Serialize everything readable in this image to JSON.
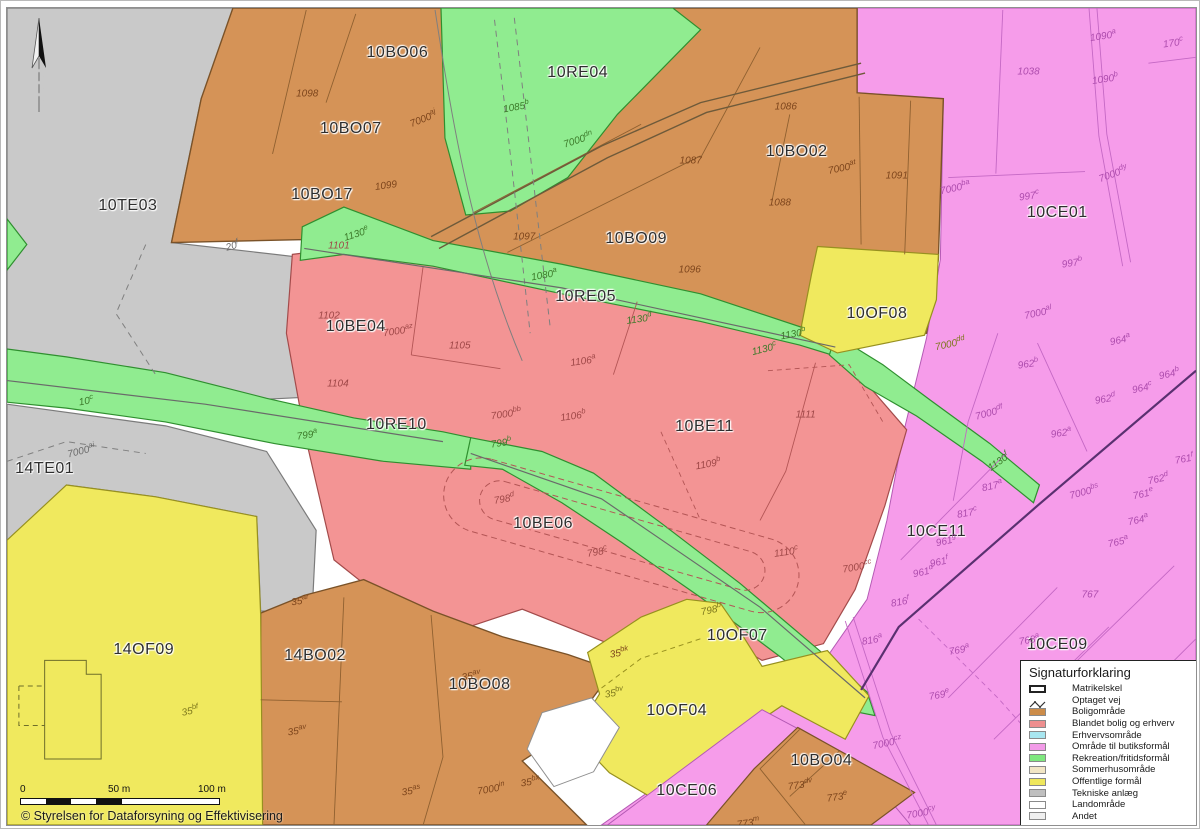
{
  "copyright": "© Styrelsen for Dataforsyning og Effektivisering",
  "scale_bar": {
    "labels": [
      "0",
      "50 m",
      "100 m"
    ]
  },
  "legend": {
    "title": "Signaturforklaring",
    "items": [
      {
        "label": "Matrikelskel",
        "symbol": "outline",
        "color": "#FFFFFF"
      },
      {
        "label": "Optaget vej",
        "symbol": "zigzag",
        "color": "#333333"
      },
      {
        "label": "Boligområde",
        "symbol": "fill",
        "color": "#CC8C49"
      },
      {
        "label": "Blandet bolig og erhverv",
        "symbol": "fill",
        "color": "#EE8F8F"
      },
      {
        "label": "Erhvervsområde",
        "symbol": "fill",
        "color": "#A8E6F0"
      },
      {
        "label": "Område til butiksformål",
        "symbol": "fill",
        "color": "#F29BE8"
      },
      {
        "label": "Rekreation/fritidsformål",
        "symbol": "fill",
        "color": "#7FE87F"
      },
      {
        "label": "Sommerhusområde",
        "symbol": "fill",
        "color": "#F2E6C5"
      },
      {
        "label": "Offentlige formål",
        "symbol": "fill",
        "color": "#EFE75C"
      },
      {
        "label": "Tekniske anlæg",
        "symbol": "fill",
        "color": "#BFBFBF"
      },
      {
        "label": "Landområde",
        "symbol": "fill",
        "color": "#FFFFFF"
      },
      {
        "label": "Andet",
        "symbol": "fill",
        "color": "#EFEFEF"
      }
    ]
  },
  "zone_colors": {
    "boligomraade": "#D59357",
    "blandet": "#F39494",
    "rekreation": "#90EC90",
    "butiksformaal": "#F69CEA",
    "offentlige": "#F0E95E",
    "tekniske": "#C9C9C9"
  },
  "zone_labels": [
    {
      "text": "10TE03",
      "x": 122,
      "y": 201
    },
    {
      "text": "10BO06",
      "x": 394,
      "y": 46
    },
    {
      "text": "10BO07",
      "x": 347,
      "y": 123
    },
    {
      "text": "10BO17",
      "x": 318,
      "y": 190
    },
    {
      "text": "10RE04",
      "x": 576,
      "y": 66
    },
    {
      "text": "10BO02",
      "x": 797,
      "y": 146
    },
    {
      "text": "10BO09",
      "x": 635,
      "y": 234
    },
    {
      "text": "10CE01",
      "x": 1060,
      "y": 208
    },
    {
      "text": "10RE05",
      "x": 584,
      "y": 293
    },
    {
      "text": "10BE04",
      "x": 352,
      "y": 324
    },
    {
      "text": "10OF08",
      "x": 878,
      "y": 310
    },
    {
      "text": "10RE10",
      "x": 393,
      "y": 423
    },
    {
      "text": "10BE11",
      "x": 704,
      "y": 425
    },
    {
      "text": "14TE01",
      "x": 38,
      "y": 468
    },
    {
      "text": "10BE06",
      "x": 541,
      "y": 524
    },
    {
      "text": "10CE11",
      "x": 938,
      "y": 532
    },
    {
      "text": "14OF09",
      "x": 138,
      "y": 651
    },
    {
      "text": "14BO02",
      "x": 311,
      "y": 658
    },
    {
      "text": "10OF07",
      "x": 737,
      "y": 637
    },
    {
      "text": "10BO08",
      "x": 477,
      "y": 687
    },
    {
      "text": "10CE09",
      "x": 1060,
      "y": 646
    },
    {
      "text": "10OF04",
      "x": 676,
      "y": 713
    },
    {
      "text": "10CE06",
      "x": 686,
      "y": 794
    },
    {
      "text": "10BO04",
      "x": 822,
      "y": 764
    }
  ],
  "parcel_labels": [
    {
      "base": "1098",
      "sup": "",
      "x": 303,
      "y": 87,
      "tone": "o",
      "rot": 0
    },
    {
      "base": "7000",
      "sup": "aj",
      "x": 420,
      "y": 112,
      "tone": "o",
      "rot": -22
    },
    {
      "base": "1085",
      "sup": "b",
      "x": 514,
      "y": 99,
      "tone": "g",
      "rot": -10
    },
    {
      "base": "7000",
      "sup": "dn",
      "x": 576,
      "y": 133,
      "tone": "g",
      "rot": -18
    },
    {
      "base": "1099",
      "sup": "",
      "x": 383,
      "y": 181,
      "tone": "o",
      "rot": -8
    },
    {
      "base": "1086",
      "sup": "",
      "x": 786,
      "y": 100,
      "tone": "o",
      "rot": 0
    },
    {
      "base": "1087",
      "sup": "",
      "x": 690,
      "y": 155,
      "tone": "o",
      "rot": 0
    },
    {
      "base": "1088",
      "sup": "",
      "x": 780,
      "y": 198,
      "tone": "o",
      "rot": 0
    },
    {
      "base": "7000",
      "sup": "at",
      "x": 843,
      "y": 161,
      "tone": "o",
      "rot": -12
    },
    {
      "base": "1091",
      "sup": "",
      "x": 898,
      "y": 170,
      "tone": "o",
      "rot": 0
    },
    {
      "base": "1090",
      "sup": "a",
      "x": 1106,
      "y": 27,
      "tone": "p",
      "rot": -8
    },
    {
      "base": "1090",
      "sup": "b",
      "x": 1108,
      "y": 71,
      "tone": "p",
      "rot": -8
    },
    {
      "base": "1038",
      "sup": "",
      "x": 1031,
      "y": 65,
      "tone": "p",
      "rot": 0
    },
    {
      "base": "170",
      "sup": "c",
      "x": 1177,
      "y": 34,
      "tone": "p",
      "rot": -8
    },
    {
      "base": "997",
      "sup": "c",
      "x": 1031,
      "y": 190,
      "tone": "p",
      "rot": -8
    },
    {
      "base": "7000",
      "sup": "dy",
      "x": 1116,
      "y": 167,
      "tone": "p",
      "rot": -20
    },
    {
      "base": "7000",
      "sup": "ba",
      "x": 957,
      "y": 182,
      "tone": "p",
      "rot": -12
    },
    {
      "base": "997",
      "sup": "b",
      "x": 1075,
      "y": 258,
      "tone": "p",
      "rot": -8
    },
    {
      "base": "20",
      "sup": "f",
      "x": 227,
      "y": 240,
      "tone": "e",
      "rot": -15
    },
    {
      "base": "1130",
      "sup": "e",
      "x": 352,
      "y": 228,
      "tone": "g",
      "rot": -18
    },
    {
      "base": "1101",
      "sup": "",
      "x": 335,
      "y": 241,
      "tone": "r",
      "rot": 0
    },
    {
      "base": "1097",
      "sup": "",
      "x": 522,
      "y": 232,
      "tone": "o",
      "rot": 0
    },
    {
      "base": "1096",
      "sup": "",
      "x": 689,
      "y": 266,
      "tone": "o",
      "rot": 0
    },
    {
      "base": "1080",
      "sup": "a",
      "x": 542,
      "y": 270,
      "tone": "g",
      "rot": -10
    },
    {
      "base": "1130",
      "sup": "d",
      "x": 638,
      "y": 315,
      "tone": "g",
      "rot": -8
    },
    {
      "base": "1102",
      "sup": "",
      "x": 325,
      "y": 313,
      "tone": "r",
      "rot": 0
    },
    {
      "base": "7000",
      "sup": "az",
      "x": 395,
      "y": 327,
      "tone": "r",
      "rot": -8
    },
    {
      "base": "1105",
      "sup": "",
      "x": 457,
      "y": 343,
      "tone": "r",
      "rot": 0
    },
    {
      "base": "1104",
      "sup": "",
      "x": 334,
      "y": 382,
      "tone": "r",
      "rot": 0
    },
    {
      "base": "1106",
      "sup": "a",
      "x": 581,
      "y": 357,
      "tone": "r",
      "rot": -8
    },
    {
      "base": "1130",
      "sup": "b",
      "x": 793,
      "y": 330,
      "tone": "g",
      "rot": -10
    },
    {
      "base": "1130",
      "sup": "c",
      "x": 764,
      "y": 345,
      "tone": "g",
      "rot": -14
    },
    {
      "base": "7000",
      "sup": "dd",
      "x": 952,
      "y": 340,
      "tone": "y",
      "rot": -12
    },
    {
      "base": "7000",
      "sup": "al",
      "x": 1041,
      "y": 308,
      "tone": "p",
      "rot": -12
    },
    {
      "base": "964",
      "sup": "a",
      "x": 1123,
      "y": 336,
      "tone": "p",
      "rot": -12
    },
    {
      "base": "964",
      "sup": "b",
      "x": 1173,
      "y": 370,
      "tone": "p",
      "rot": -12
    },
    {
      "base": "964",
      "sup": "c",
      "x": 1146,
      "y": 385,
      "tone": "p",
      "rot": -12
    },
    {
      "base": "962",
      "sup": "b",
      "x": 1030,
      "y": 360,
      "tone": "p",
      "rot": -8
    },
    {
      "base": "962",
      "sup": "d",
      "x": 1108,
      "y": 396,
      "tone": "p",
      "rot": -10
    },
    {
      "base": "962",
      "sup": "a",
      "x": 1064,
      "y": 430,
      "tone": "p",
      "rot": -8
    },
    {
      "base": "7000",
      "sup": "df",
      "x": 991,
      "y": 410,
      "tone": "p",
      "rot": -15
    },
    {
      "base": "10",
      "sup": "c",
      "x": 80,
      "y": 398,
      "tone": "g",
      "rot": -10
    },
    {
      "base": "7000",
      "sup": "ai",
      "x": 75,
      "y": 448,
      "tone": "e",
      "rot": -14
    },
    {
      "base": "799",
      "sup": "a",
      "x": 303,
      "y": 432,
      "tone": "g",
      "rot": -8
    },
    {
      "base": "7000",
      "sup": "bb",
      "x": 504,
      "y": 411,
      "tone": "r",
      "rot": -8
    },
    {
      "base": "1106",
      "sup": "b",
      "x": 571,
      "y": 413,
      "tone": "r",
      "rot": -8
    },
    {
      "base": "799",
      "sup": "b",
      "x": 499,
      "y": 440,
      "tone": "g",
      "rot": -8
    },
    {
      "base": "1109",
      "sup": "b",
      "x": 707,
      "y": 462,
      "tone": "r",
      "rot": -10
    },
    {
      "base": "1111",
      "sup": "",
      "x": 806,
      "y": 413,
      "tone": "r",
      "rot": 0
    },
    {
      "base": "1130",
      "sup": "f",
      "x": 1000,
      "y": 460,
      "tone": "g",
      "rot": -35
    },
    {
      "base": "817",
      "sup": "a",
      "x": 994,
      "y": 484,
      "tone": "p",
      "rot": -12
    },
    {
      "base": "7000",
      "sup": "bs",
      "x": 1087,
      "y": 490,
      "tone": "p",
      "rot": -15
    },
    {
      "base": "761",
      "sup": "f",
      "x": 1188,
      "y": 457,
      "tone": "p",
      "rot": -10
    },
    {
      "base": "762",
      "sup": "d",
      "x": 1162,
      "y": 477,
      "tone": "p",
      "rot": -12
    },
    {
      "base": "761",
      "sup": "e",
      "x": 1147,
      "y": 492,
      "tone": "p",
      "rot": -12
    },
    {
      "base": "764",
      "sup": "a",
      "x": 1141,
      "y": 518,
      "tone": "p",
      "rot": -12
    },
    {
      "base": "765",
      "sup": "a",
      "x": 1121,
      "y": 541,
      "tone": "p",
      "rot": -12
    },
    {
      "base": "817",
      "sup": "c",
      "x": 969,
      "y": 511,
      "tone": "p",
      "rot": -10
    },
    {
      "base": "961",
      "sup": "g",
      "x": 948,
      "y": 540,
      "tone": "p",
      "rot": -12
    },
    {
      "base": "961",
      "sup": "f",
      "x": 941,
      "y": 561,
      "tone": "p",
      "rot": -12
    },
    {
      "base": "961",
      "sup": "d",
      "x": 924,
      "y": 571,
      "tone": "p",
      "rot": -12
    },
    {
      "base": "816",
      "sup": "f",
      "x": 901,
      "y": 602,
      "tone": "p",
      "rot": -10
    },
    {
      "base": "816",
      "sup": "a",
      "x": 873,
      "y": 640,
      "tone": "p",
      "rot": -10
    },
    {
      "base": "769",
      "sup": "a",
      "x": 961,
      "y": 650,
      "tone": "p",
      "rot": -10
    },
    {
      "base": "769",
      "sup": "e",
      "x": 941,
      "y": 696,
      "tone": "p",
      "rot": -10
    },
    {
      "base": "768",
      "sup": "a",
      "x": 1031,
      "y": 640,
      "tone": "p",
      "rot": -10
    },
    {
      "base": "767",
      "sup": "",
      "x": 1093,
      "y": 596,
      "tone": "p",
      "rot": 0
    },
    {
      "base": "798",
      "sup": "d",
      "x": 502,
      "y": 497,
      "tone": "r",
      "rot": -10
    },
    {
      "base": "798",
      "sup": "c",
      "x": 595,
      "y": 551,
      "tone": "r",
      "rot": -10
    },
    {
      "base": "1110",
      "sup": "c",
      "x": 786,
      "y": 551,
      "tone": "r",
      "rot": -8
    },
    {
      "base": "7000",
      "sup": "cc",
      "x": 858,
      "y": 566,
      "tone": "r",
      "rot": -10
    },
    {
      "base": "798",
      "sup": "b",
      "x": 711,
      "y": 610,
      "tone": "y",
      "rot": -12
    },
    {
      "base": "35",
      "sup": "ar",
      "x": 296,
      "y": 601,
      "tone": "o",
      "rot": -8
    },
    {
      "base": "35",
      "sup": "av",
      "x": 468,
      "y": 677,
      "tone": "o",
      "rot": -8
    },
    {
      "base": "35",
      "sup": "av",
      "x": 293,
      "y": 733,
      "tone": "o",
      "rot": -8
    },
    {
      "base": "35",
      "sup": "bk",
      "x": 618,
      "y": 653,
      "tone": "o",
      "rot": -10
    },
    {
      "base": "35",
      "sup": "bv",
      "x": 613,
      "y": 694,
      "tone": "y",
      "rot": -10
    },
    {
      "base": "35",
      "sup": "bf",
      "x": 185,
      "y": 712,
      "tone": "y",
      "rot": -12
    },
    {
      "base": "35",
      "sup": "bx",
      "x": 528,
      "y": 784,
      "tone": "o",
      "rot": -8
    },
    {
      "base": "35",
      "sup": "as",
      "x": 408,
      "y": 793,
      "tone": "o",
      "rot": -8
    },
    {
      "base": "7000",
      "sup": "in",
      "x": 488,
      "y": 791,
      "tone": "o",
      "rot": -10
    },
    {
      "base": "773",
      "sup": "dv",
      "x": 800,
      "y": 787,
      "tone": "o",
      "rot": -8
    },
    {
      "base": "773",
      "sup": "e",
      "x": 838,
      "y": 800,
      "tone": "o",
      "rot": -8
    },
    {
      "base": "773",
      "sup": "m",
      "x": 748,
      "y": 826,
      "tone": "o",
      "rot": -8
    },
    {
      "base": "7000",
      "sup": "cz",
      "x": 888,
      "y": 745,
      "tone": "p",
      "rot": -12
    },
    {
      "base": "7000",
      "sup": "cy",
      "x": 922,
      "y": 816,
      "tone": "p",
      "rot": -10
    }
  ]
}
